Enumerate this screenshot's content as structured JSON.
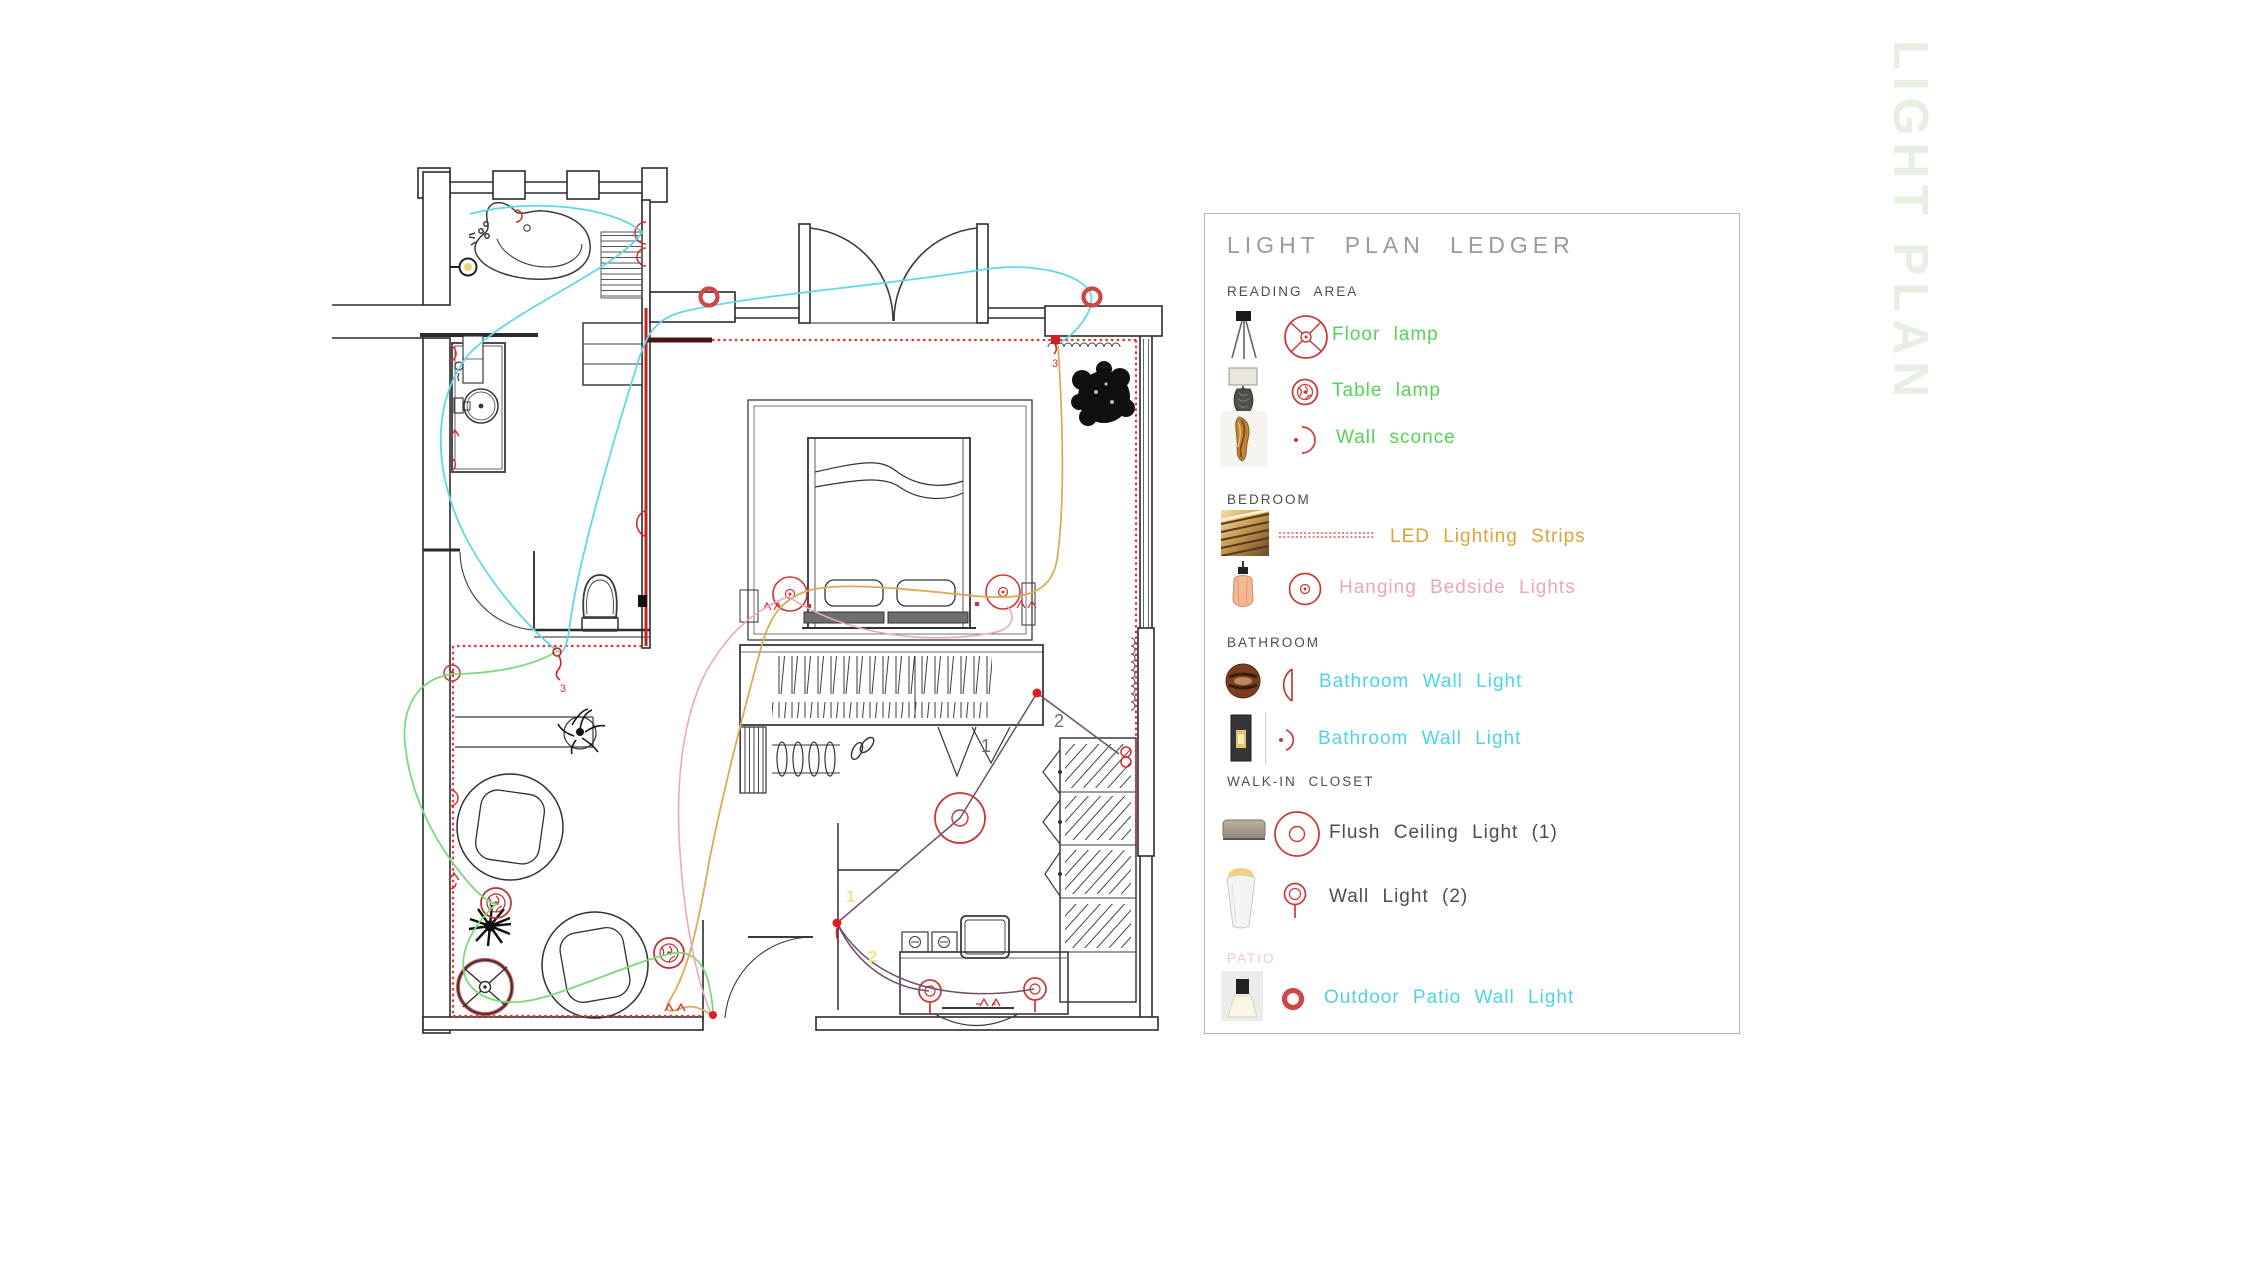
{
  "watermark": "LIGHT PLAN",
  "legend": {
    "title": "LIGHT PLAN LEDGER",
    "sections": [
      {
        "name": "READING AREA",
        "color": "#4c4c4c",
        "items": [
          {
            "label": "Floor lamp",
            "color": "#53d453",
            "icon": "floor-lamp",
            "symbol": "fan-circle"
          },
          {
            "label": "Table lamp",
            "color": "#53d453",
            "icon": "table-lamp",
            "symbol": "rosette-circle"
          },
          {
            "label": "Wall sconce",
            "color": "#53d453",
            "icon": "wall-sconce",
            "symbol": "arc-dot"
          }
        ]
      },
      {
        "name": "BEDROOM",
        "color": "#4c4c4c",
        "items": [
          {
            "label": "LED Lighting Strips",
            "color": "#d8a53d",
            "icon": "led-strip",
            "symbol": "dashed-strip"
          },
          {
            "label": "Hanging Bedside Lights",
            "color": "#eba6bd",
            "icon": "pendant-light",
            "symbol": "circle-dot"
          }
        ]
      },
      {
        "name": "BATHROOM",
        "color": "#4c4c4c",
        "items": [
          {
            "label": "Bathroom Wall Light",
            "color": "#4ed3e3",
            "icon": "round-wood-light",
            "symbol": "half-lens"
          },
          {
            "label": "Bathroom Wall Light",
            "color": "#4ed3e3",
            "icon": "tube-wall-light",
            "symbol": "small-arc-dot"
          }
        ]
      },
      {
        "name": "WALK-IN CLOSET",
        "color": "#4c4c4c",
        "items": [
          {
            "label": "Flush Ceiling Light (1)",
            "color": "#4d4d4d",
            "icon": "flush-drum",
            "symbol": "double-circle"
          },
          {
            "label": "Wall Light (2)",
            "color": "#4d4d4d",
            "icon": "cone-wall-light",
            "symbol": "circle-stem"
          }
        ]
      },
      {
        "name": "PATIO",
        "color": "#f2c6d0",
        "items": [
          {
            "label": "Outdoor Patio Wall Light",
            "color": "#4ed3e3",
            "icon": "outdoor-box-light",
            "symbol": "bold-ring"
          }
        ]
      }
    ]
  },
  "plan": {
    "labels": {
      "closet_circuit_1": "1",
      "closet_circuit_2": "2",
      "desk_circuit_1": "1",
      "desk_circuit_2": "2",
      "led_circuit": "3",
      "switch_circuit": "3"
    },
    "colors": {
      "wire_cyan": "#62d7e6",
      "wire_green": "#7cd87c",
      "wire_gold": "#ddaa55",
      "wire_pink": "#eaa8c0",
      "wire_purple": "#6e4f6b",
      "symbol_red": "#cf3434",
      "led_red": "#e23333",
      "number_yellow": "#e9e98a",
      "number_gray": "#6a6a6a"
    }
  }
}
